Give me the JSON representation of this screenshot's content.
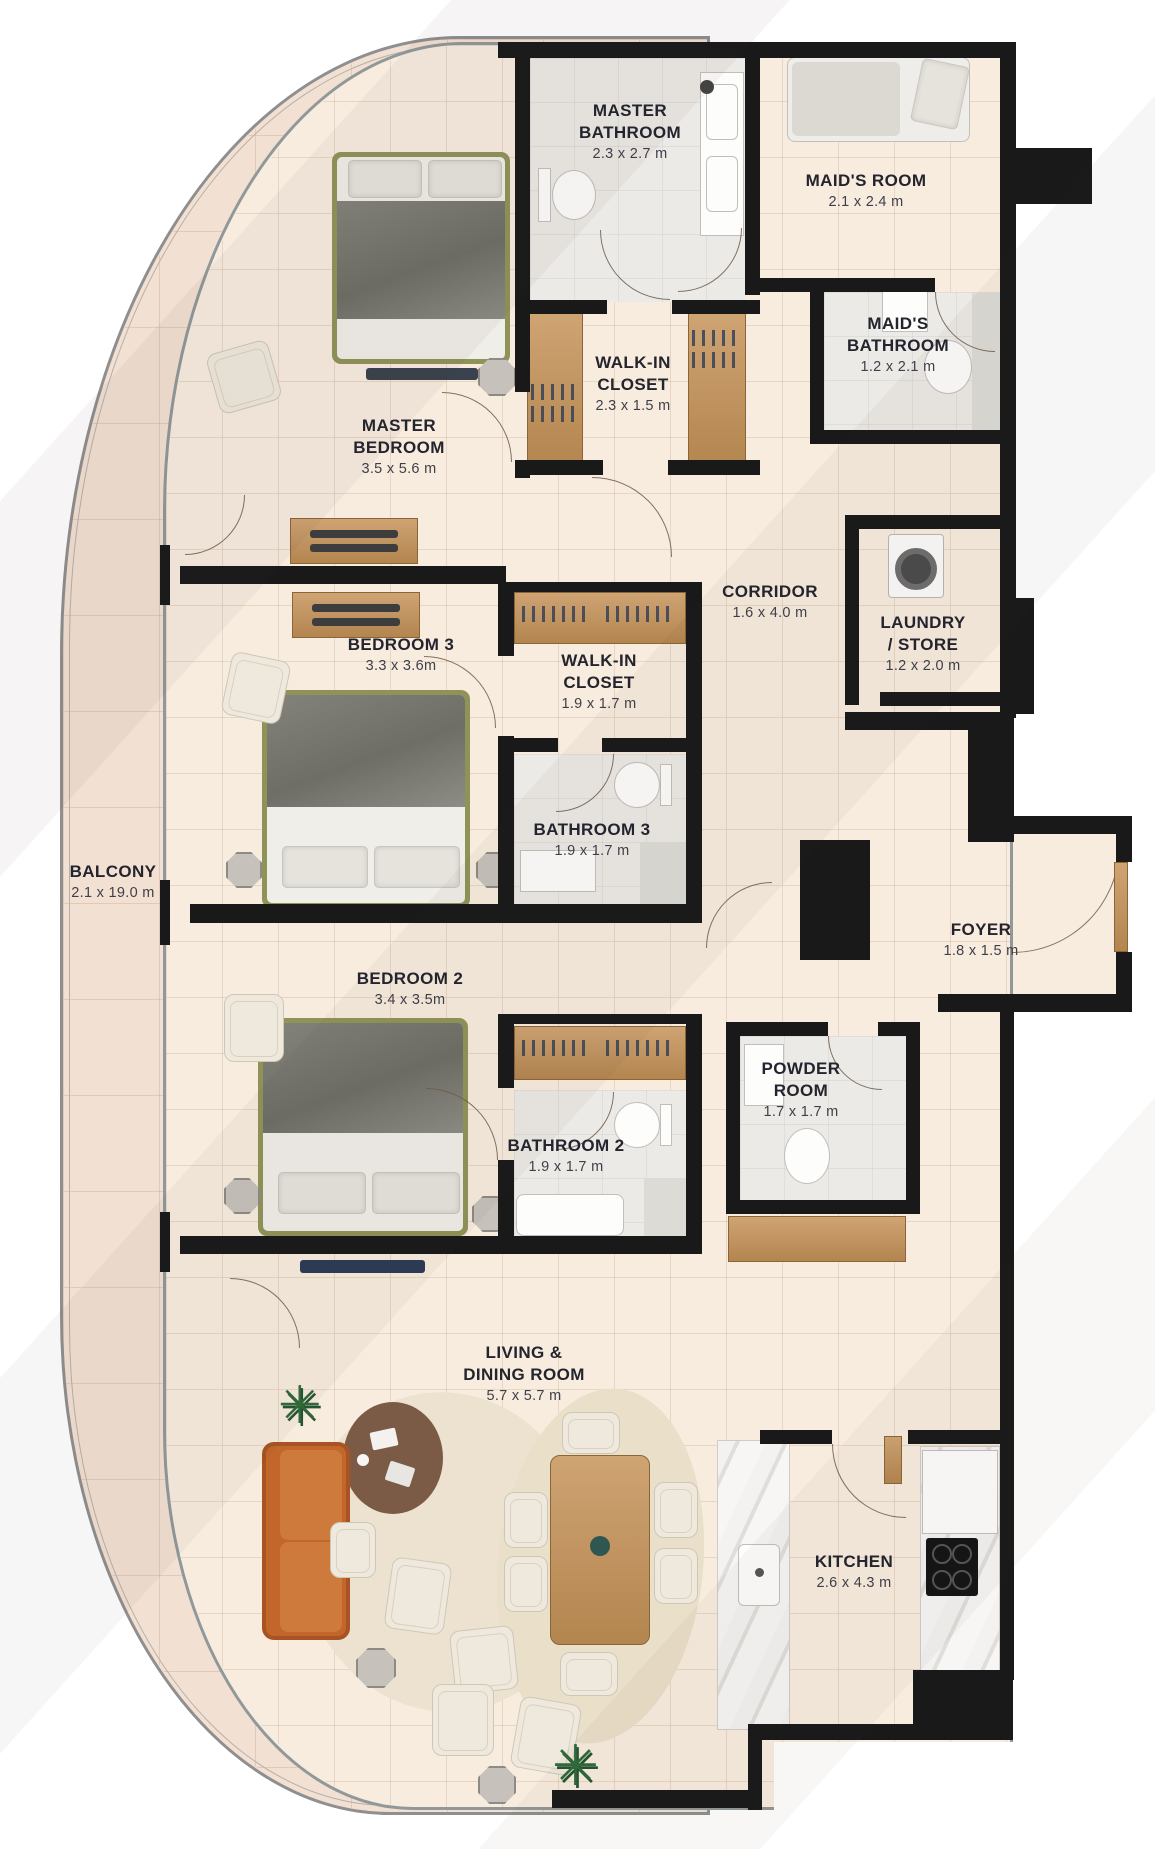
{
  "plan": {
    "type": "apartment-floor-plan",
    "rooms": [
      {
        "id": "master-bathroom",
        "lines": [
          "MASTER",
          "BATHROOM"
        ],
        "dim": "2.3 x 2.7 m"
      },
      {
        "id": "maids-room",
        "lines": [
          "MAID'S ROOM"
        ],
        "dim": "2.1 x 2.4 m"
      },
      {
        "id": "maids-bathroom",
        "lines": [
          "MAID'S",
          "BATHROOM"
        ],
        "dim": "1.2 x 2.1 m"
      },
      {
        "id": "walk-in-closet-master",
        "lines": [
          "WALK-IN",
          "CLOSET"
        ],
        "dim": "2.3 x 1.5 m"
      },
      {
        "id": "master-bedroom",
        "lines": [
          "MASTER",
          "BEDROOM"
        ],
        "dim": "3.5 x 5.6 m"
      },
      {
        "id": "corridor",
        "lines": [
          "CORRIDOR"
        ],
        "dim": "1.6 x 4.0 m"
      },
      {
        "id": "laundry-store",
        "lines": [
          "LAUNDRY",
          "/ STORE"
        ],
        "dim": "1.2 x 2.0 m"
      },
      {
        "id": "bedroom-3",
        "lines": [
          "BEDROOM 3"
        ],
        "dim": "3.3 x 3.6m"
      },
      {
        "id": "walk-in-closet-2",
        "lines": [
          "WALK-IN",
          "CLOSET"
        ],
        "dim": "1.9 x 1.7 m"
      },
      {
        "id": "bathroom-3",
        "lines": [
          "BATHROOM 3"
        ],
        "dim": "1.9 x 1.7 m"
      },
      {
        "id": "balcony",
        "lines": [
          "BALCONY"
        ],
        "dim": "2.1 x 19.0 m"
      },
      {
        "id": "foyer",
        "lines": [
          "FOYER"
        ],
        "dim": "1.8 x 1.5 m"
      },
      {
        "id": "bedroom-2",
        "lines": [
          "BEDROOM 2"
        ],
        "dim": "3.4 x 3.5m"
      },
      {
        "id": "powder-room",
        "lines": [
          "POWDER",
          "ROOM"
        ],
        "dim": "1.7 x 1.7 m"
      },
      {
        "id": "bathroom-2",
        "lines": [
          "BATHROOM 2"
        ],
        "dim": "1.9 x 1.7 m"
      },
      {
        "id": "living-dining",
        "lines": [
          "LIVING &",
          "DINING ROOM"
        ],
        "dim": "5.7 x 5.7 m"
      },
      {
        "id": "kitchen",
        "lines": [
          "KITCHEN"
        ],
        "dim": "2.6 x 4.3 m"
      }
    ],
    "colors": {
      "wall": "#191919",
      "interior_floor": "#f8ecdf",
      "balcony_floor": "#f2e0d2",
      "wood": "#c2996a",
      "sofa": "#c2662b",
      "bed_frame": "#8f9358",
      "marble": "#eceae6",
      "label_text": "#24242e"
    }
  }
}
